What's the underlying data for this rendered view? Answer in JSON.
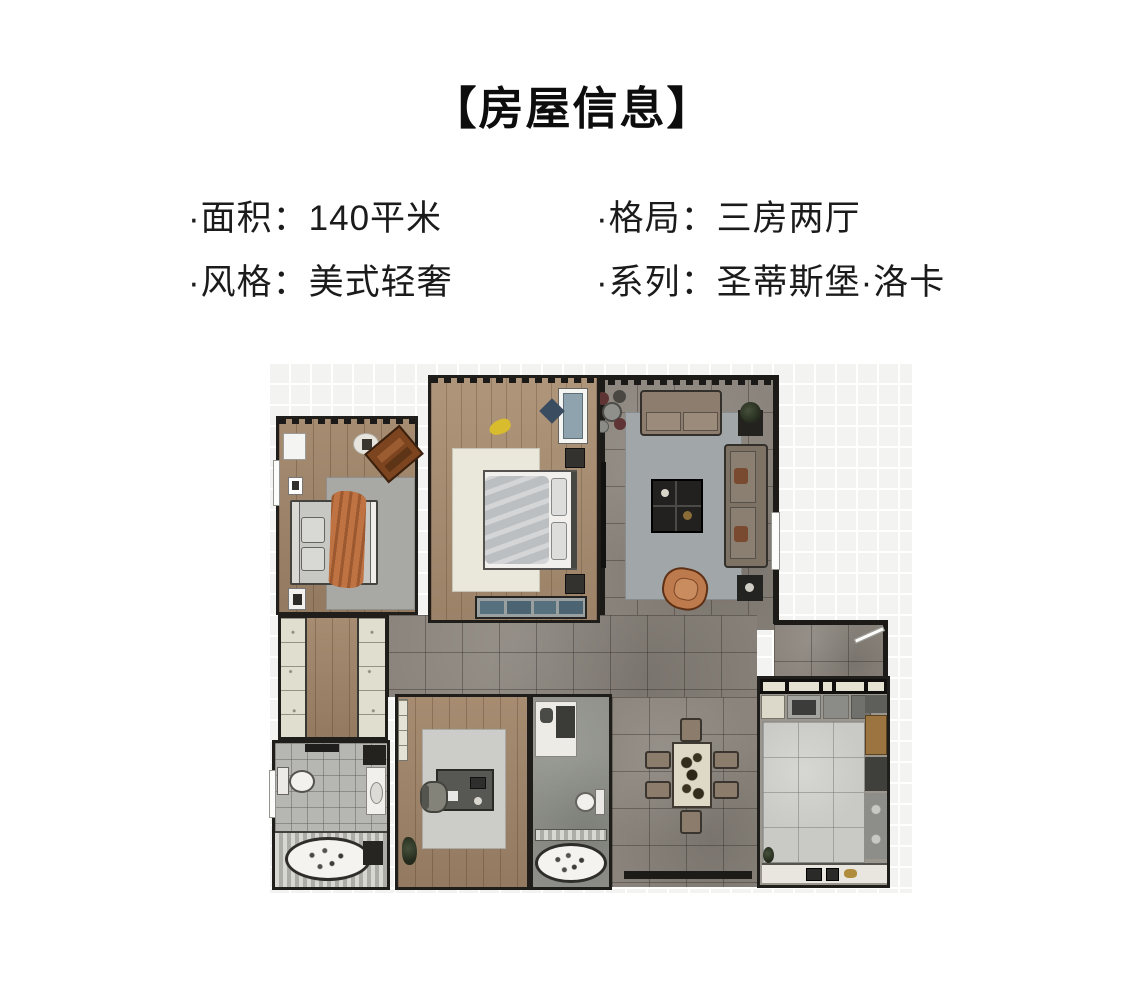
{
  "header": {
    "title": "【房屋信息】"
  },
  "info": {
    "items": [
      {
        "label": "·面积：140平米"
      },
      {
        "label": "·格局：三房两厅"
      },
      {
        "label": "·风格：美式轻奢"
      },
      {
        "label": "·系列：圣蒂斯堡·洛卡"
      }
    ]
  },
  "floorplan": {
    "description_colors": {
      "wood_floor": "#9c8166",
      "tile_floor": "#8a847c",
      "kitchen_floor": "#c9c9c5",
      "bath_main_floor": "#b6b6b2",
      "bath_second_floor": "#8f918a",
      "wall": "#1d1b18",
      "canvas_grid": "#f3f3f1",
      "accent_orange": "#bf7242",
      "accent_blue": "#57707e",
      "accent_brown": "#7c441f",
      "rug_gray": "#a8a8a4",
      "rug_cream": "#eae7db"
    }
  }
}
